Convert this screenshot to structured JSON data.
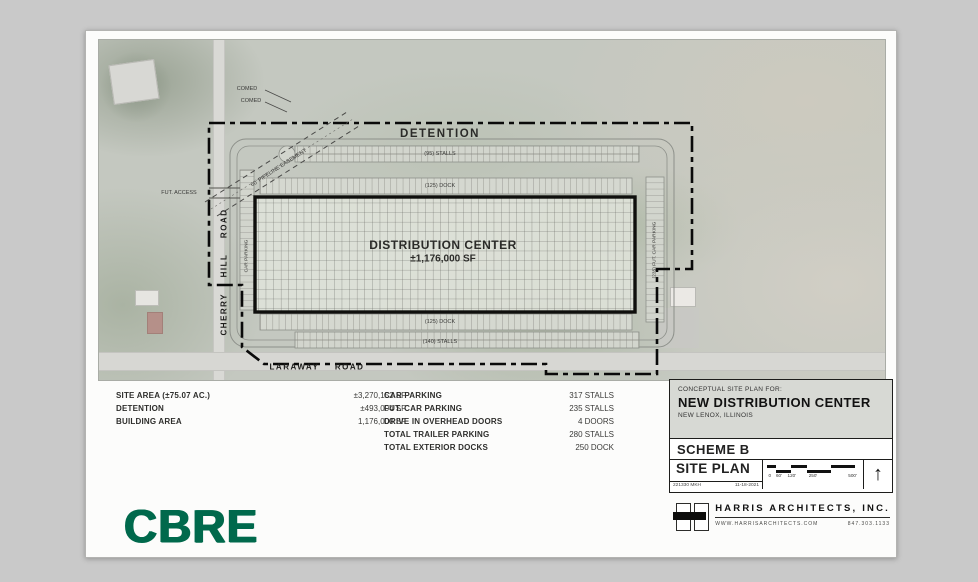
{
  "plan": {
    "detention": "DETENTION",
    "building_title": "DISTRIBUTION CENTER",
    "building_area": "±1,176,000 SF",
    "labels": {
      "comed1": "COMED",
      "comed2": "COMED",
      "pipeline": "60' PIPELINE EASEMENT",
      "fut_access": "FUT. ACCESS",
      "top_stalls": "(95) STALLS",
      "top_dock": "(125) DOCK",
      "bottom_dock": "(125) DOCK",
      "bottom_stalls": "(140) STALLS",
      "cherry_hill_road": "CHERRY HILL ROAD",
      "laraway_road": "LARAWAY ROAD",
      "left_parking": "CAR PARKING",
      "right_parking": "(235) FUT. CAR PARKING"
    }
  },
  "area_table": {
    "rows": [
      {
        "label": "SITE AREA (±75.07 AC.)",
        "value": "±3,270,152 SF"
      },
      {
        "label": "DETENTION",
        "value": "±493,004 SF"
      },
      {
        "label": "BUILDING AREA",
        "value": "1,176,000 SF"
      }
    ]
  },
  "parking_table": {
    "rows": [
      {
        "label": "CAR PARKING",
        "value": "317 STALLS"
      },
      {
        "label": "FUT. CAR PARKING",
        "value": "235 STALLS"
      },
      {
        "label": "DRIVE IN OVERHEAD DOORS",
        "value": "4 DOORS"
      },
      {
        "label": "TOTAL TRAILER PARKING",
        "value": "280 STALLS"
      },
      {
        "label": "TOTAL EXTERIOR DOCKS",
        "value": "250 DOCK"
      }
    ]
  },
  "title_block": {
    "for_label": "CONCEPTUAL SITE PLAN FOR:",
    "project": "NEW DISTRIBUTION CENTER",
    "location": "NEW LENOX, ILLINOIS",
    "scheme": "SCHEME B",
    "sheet_name": "SITE PLAN",
    "job_no": "221330 MKH",
    "date": "11-18-2021",
    "scale_ticks": [
      "0",
      "60'",
      "120'",
      "250'",
      "500'"
    ],
    "north_arrow": "↑"
  },
  "footer": {
    "cbre": "CBRE",
    "architect": "HARRIS ARCHITECTS, INC.",
    "website": "WWW.HARRISARCHITECTS.COM",
    "phone": "847.303.1133"
  },
  "colors": {
    "cbre_green": "#00694C"
  }
}
